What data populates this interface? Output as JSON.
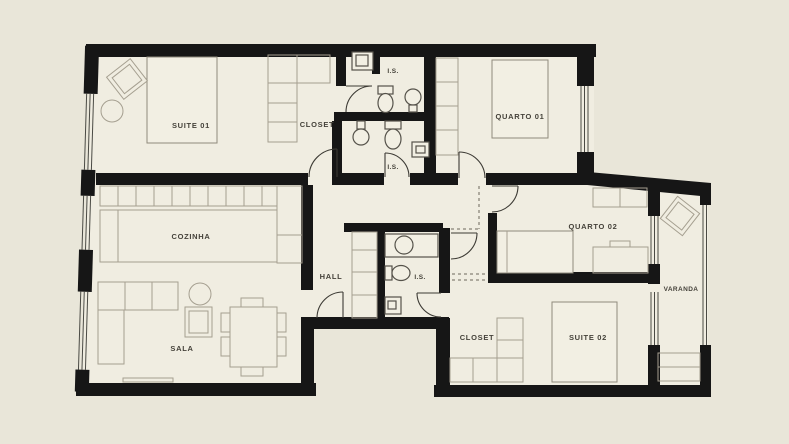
{
  "plan_type": "apartment-floor-plan",
  "rooms": {
    "suite01": {
      "label": "SUITE 01"
    },
    "closet1": {
      "label": "CLOSET"
    },
    "is1": {
      "label": "I.S."
    },
    "is2": {
      "label": "I.S."
    },
    "quarto01": {
      "label": "QUARTO 01"
    },
    "cozinha": {
      "label": "COZINHA"
    },
    "hall": {
      "label": "HALL"
    },
    "is3": {
      "label": "I.S."
    },
    "quarto02": {
      "label": "QUARTO 02"
    },
    "varanda": {
      "label": "VARANDA"
    },
    "sala": {
      "label": "SALA"
    },
    "closet2": {
      "label": "CLOSET"
    },
    "suite02": {
      "label": "SUITE 02"
    }
  },
  "colors": {
    "background": "#e9e6d9",
    "floor": "#f0ede1",
    "walls": "#161616",
    "furniture_lines": "#a59f90",
    "fixture_lines": "#55524a",
    "label_text": "#45423a"
  }
}
